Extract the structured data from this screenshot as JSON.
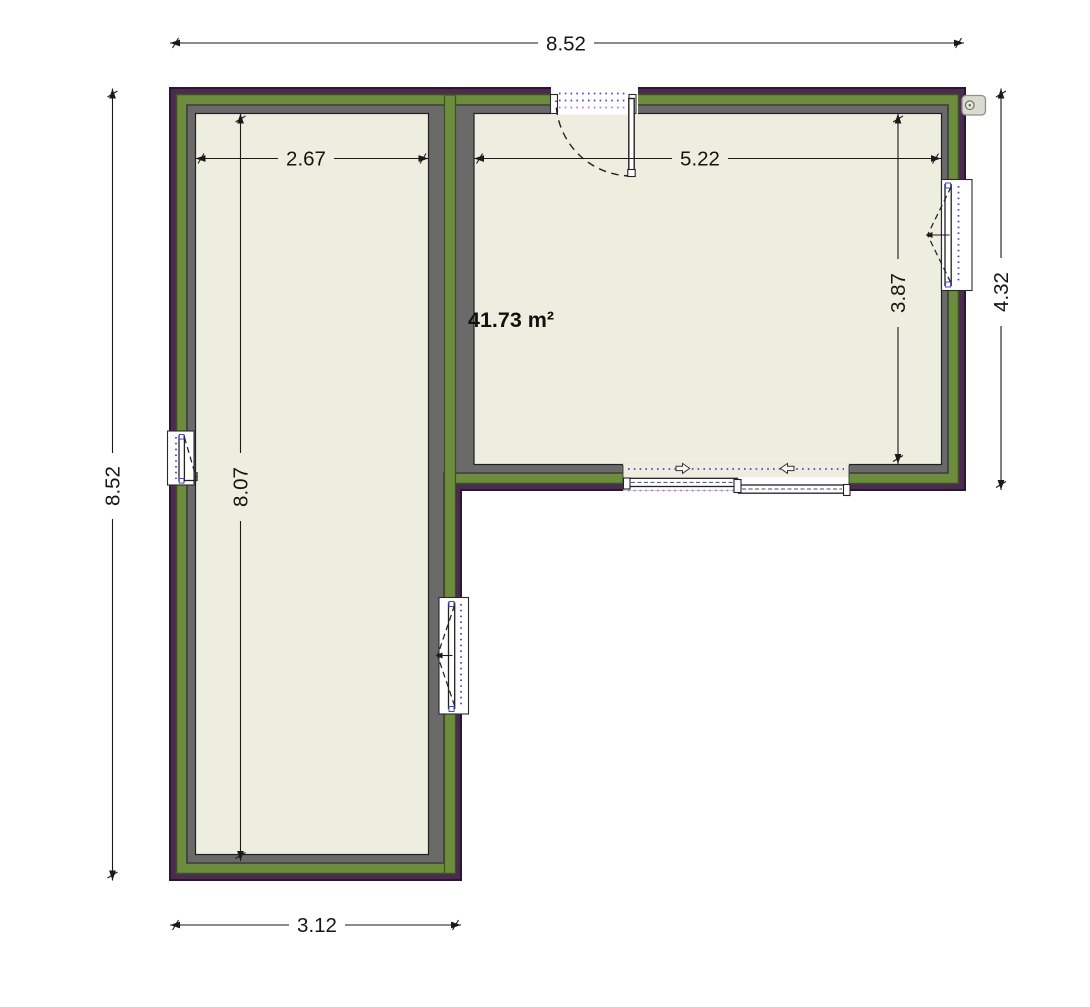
{
  "floorplan": {
    "area_label": "41.73 m²",
    "dimensions": {
      "overall_width": "8.52",
      "overall_height": "8.52",
      "right_wing_height": "4.32",
      "left_wing_width": "3.12",
      "left_room_width": "2.67",
      "right_room_width": "5.22",
      "left_room_depth": "8.07",
      "right_room_depth": "3.87"
    },
    "colors": {
      "wall_outer": "#4b2b52",
      "wall_core": "#6c8c3e",
      "wall_inner": "#6a6a6a",
      "floor": "#eeeee0",
      "opening_marks_blue": "#4646d2",
      "opening_marks_magenta": "#c46ec4"
    }
  }
}
